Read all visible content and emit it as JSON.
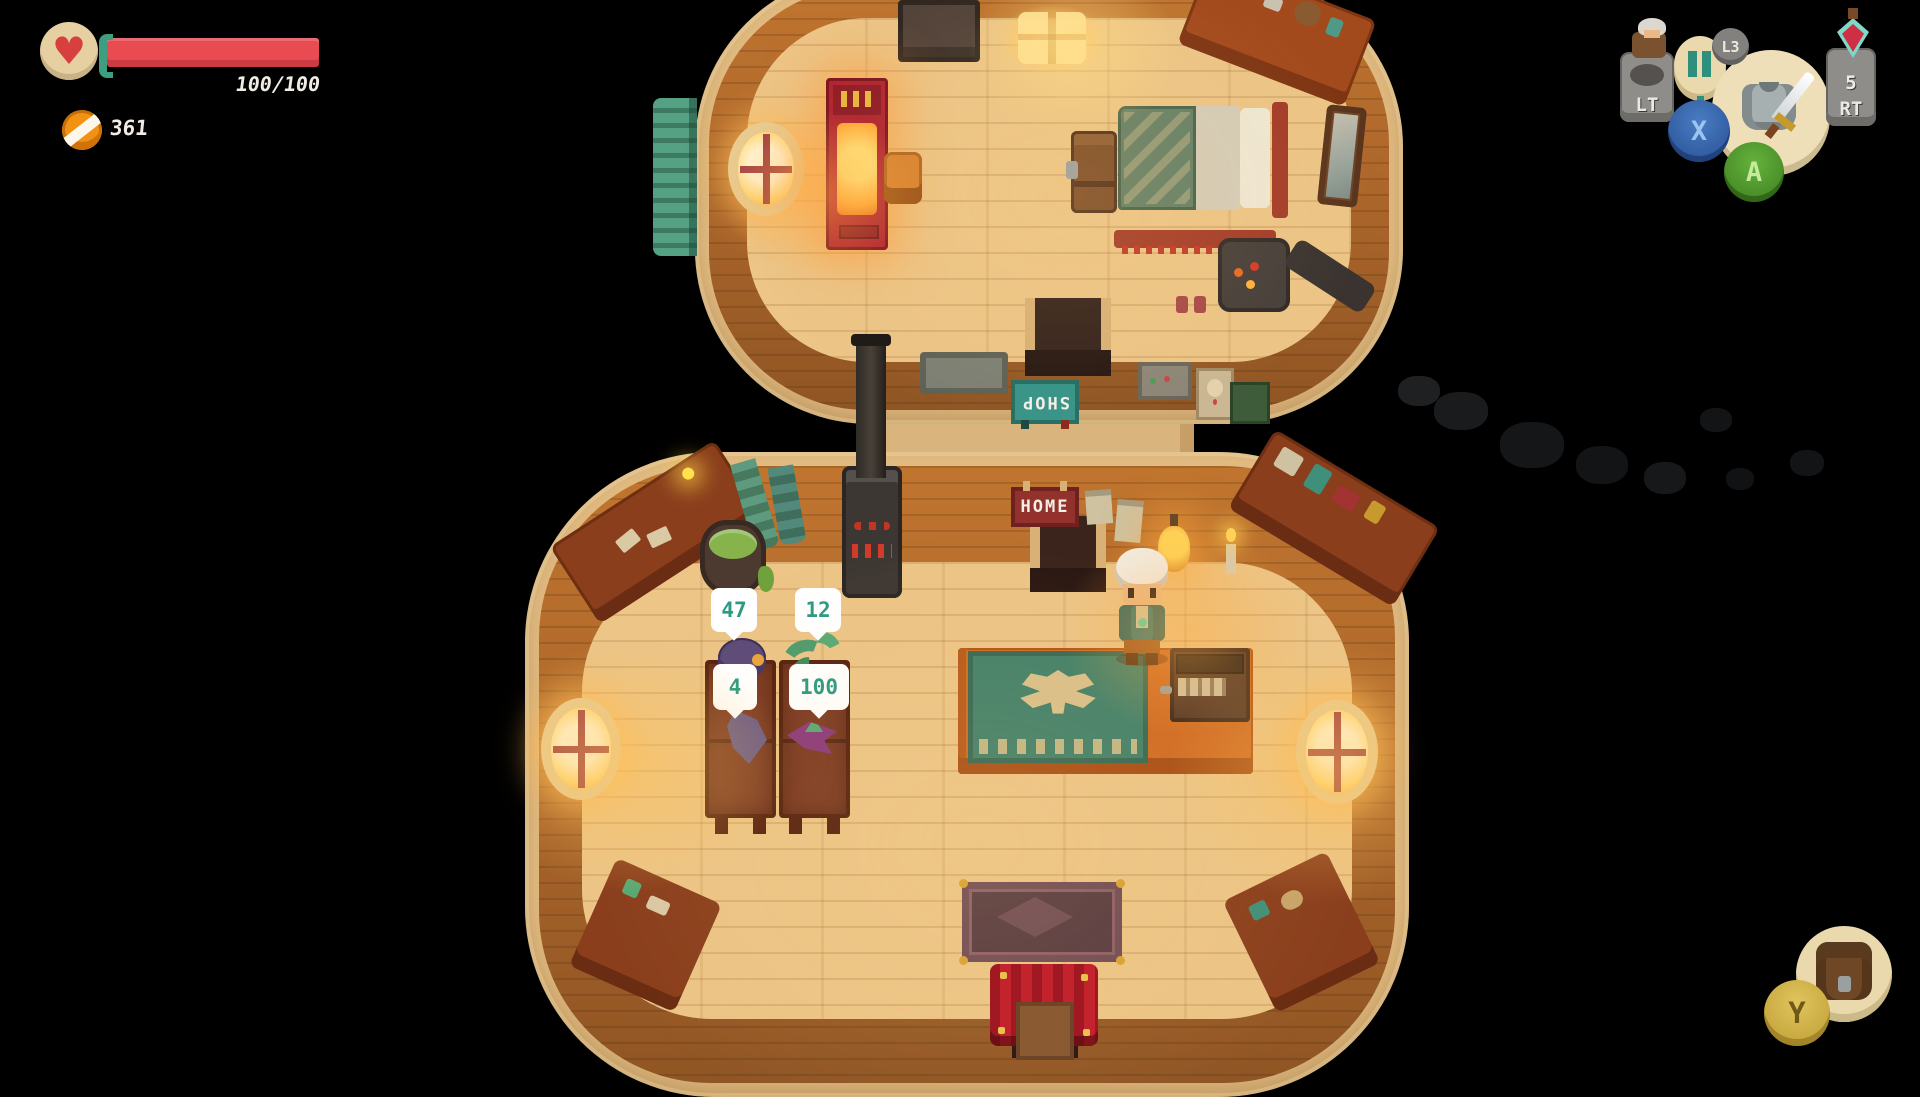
{
  "hud": {
    "health": {
      "value": "100/100",
      "bar_color": "#e84b52",
      "heart_glyph": "♥"
    },
    "coins": {
      "value": "361",
      "coin_color": "#f29212"
    },
    "controls": {
      "lt_label": "LT",
      "l3_label": "L3",
      "rt_label": "RT",
      "potion_count": "5",
      "x_label": "X",
      "a_label": "A",
      "y_label": "Y"
    }
  },
  "shop": {
    "shop_sign": "SHOP",
    "home_sign": "HOME",
    "sign_colors": {
      "shop_bg": "#3b9488",
      "home_bg": "#93312c"
    },
    "price_tags": [
      {
        "item": "purple-hat",
        "price": "47"
      },
      {
        "item": "green-tentacle",
        "price": "12"
      },
      {
        "item": "purple-fang",
        "price": "4"
      },
      {
        "item": "sea-creature",
        "price": "100"
      }
    ],
    "price_text_color": "#2a9a82"
  }
}
